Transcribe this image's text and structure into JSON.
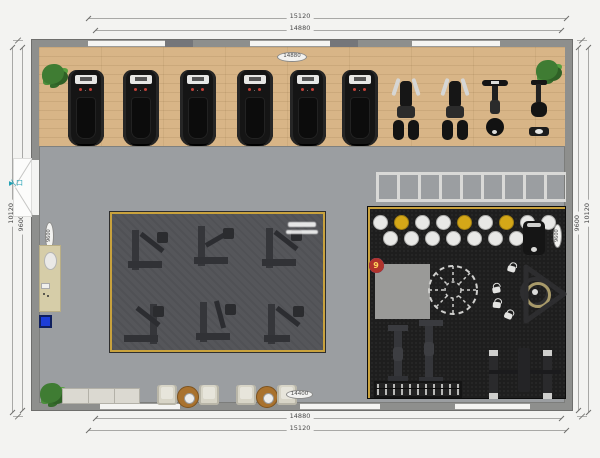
{
  "dimensions": {
    "top_outer": "15120",
    "top_inner": "14880",
    "bottom_inner": "14880",
    "bottom_outer": "15120",
    "left_outer": "10120",
    "left_inner": "9600",
    "right_inner": "9600",
    "right_outer": "10120"
  },
  "bubbles": {
    "top": "14880",
    "bottom": "14400",
    "left": "9600",
    "right": "9600"
  },
  "entrance": {
    "label": "入口",
    "arrow": "▶"
  },
  "agility_grid": {
    "cells": [
      {
        "n": "1",
        "color": "red"
      },
      {
        "n": "2",
        "color": "blue"
      },
      {
        "n": "3",
        "color": "red"
      },
      {
        "n": "4",
        "color": "blue"
      },
      {
        "n": "5",
        "color": "red"
      },
      {
        "n": "6",
        "color": "blue"
      },
      {
        "n": "7",
        "color": "red"
      },
      {
        "n": "8",
        "color": "blue"
      },
      {
        "n": "9",
        "color": "red"
      }
    ]
  },
  "colors": {
    "wood_floor": "#d8b587",
    "main_floor": "#9b9ea1",
    "strength_zone": "#55565a",
    "functional_zone": "#1e1e1e",
    "zone_border_gold": "#c9a23d",
    "entrance_teal": "#1fa0b4",
    "grid_red": "#b0342c",
    "grid_blue": "#3355cf",
    "ball_yellow": "#d4a718",
    "mat_blue": "#1d3ed8"
  }
}
